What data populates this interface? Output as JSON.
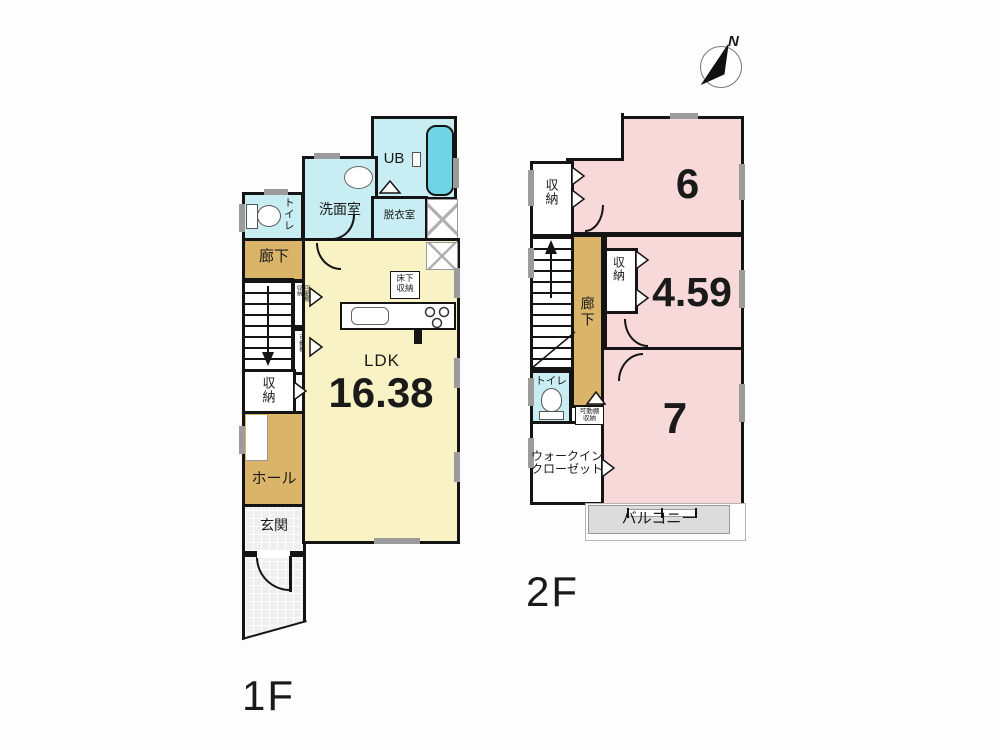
{
  "compass": {
    "north_label": "N"
  },
  "floor1": {
    "label": "1F",
    "rooms": {
      "ldk_name": "LDK",
      "ldk_size": "16.38",
      "genkan": "玄関",
      "hall": "ホール",
      "shuno": "収納",
      "rouka": "廊下",
      "toilet": "トイレ",
      "senmen": "洗面室",
      "ub": "UB",
      "datsui": "脱衣室",
      "yukashita_shuno": "床下\n収納",
      "kadoudana_shuno": "可動棚\n収納",
      "kadoudana": "可動棚"
    }
  },
  "floor2": {
    "label": "2F",
    "rooms": {
      "room6": "6",
      "room459": "4.59",
      "room7": "7",
      "shuno_top": "収納",
      "shuno_mid": "収納",
      "rouka": "廊下",
      "toilet": "トイレ",
      "kadoudana_shuno": "可動棚\n収納",
      "wic": "ウォークイン\nクローゼット",
      "balcony": "バルコニー"
    }
  },
  "colors": {
    "wall": "#141414",
    "ldk_yellow": "#f9f2c4",
    "bedroom_pink": "#f8d9d9",
    "corridor_tan": "#d9b469",
    "wet_area_cyan": "#c8edf3",
    "bathtub_cyan": "#6fd5e5",
    "balcony_gray": "#dcdcdc"
  }
}
